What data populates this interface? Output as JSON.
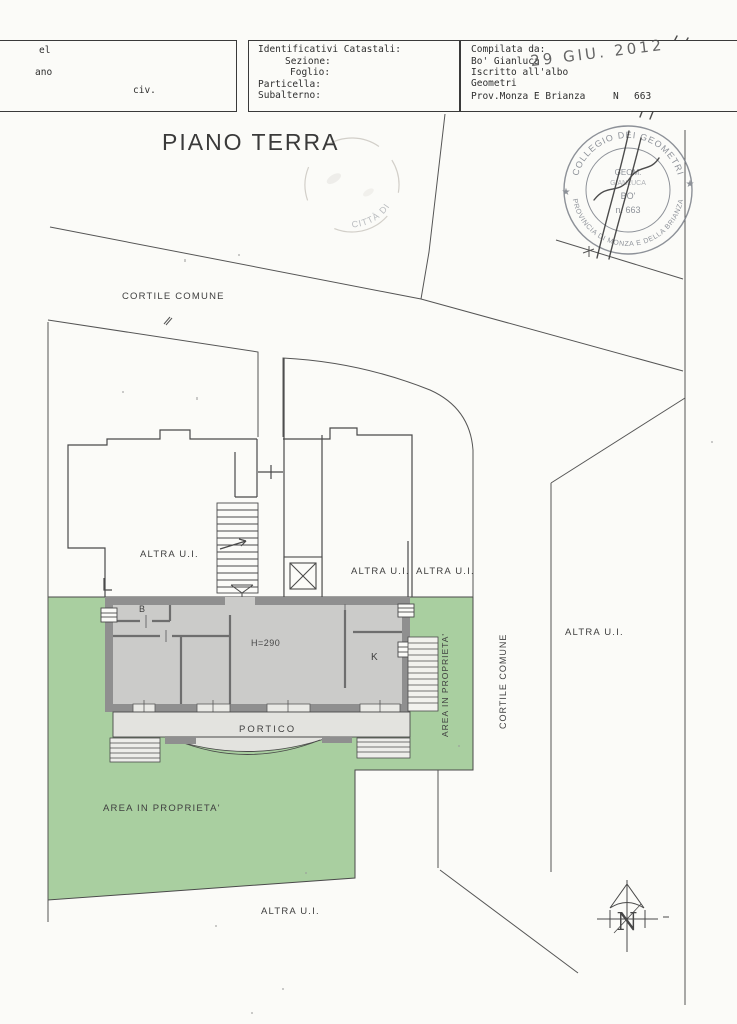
{
  "header": {
    "left_box": {
      "line1": "el",
      "line2": "ano",
      "line3": "civ."
    },
    "cadastral_box": {
      "title": "Identificativi Catastali:",
      "sezione": "Sezione:",
      "foglio": "Foglio:",
      "particella": "Particella:",
      "subalterno": "Subalterno:"
    },
    "compiler_box": {
      "compilata_da": "Compilata da:",
      "name": "Bo' Gianluca",
      "iscritto": "Iscritto all'albo",
      "geometri": "Geometri",
      "prov": "Prov.Monza E Brianza",
      "n_label": "N",
      "number": "663"
    },
    "date_stamp": "29 GIU. 2012"
  },
  "plan": {
    "title": "PIANO TERRA",
    "labels": {
      "cortile_comune": "CORTILE COMUNE",
      "altra_ui": "ALTRA U.I.",
      "area_in_proprieta": "AREA IN PROPRIETA'",
      "portico": "PORTICO",
      "room_b": "B",
      "room_k": "K",
      "height": "H=290",
      "north": "N"
    }
  },
  "stamps": {
    "collegio": {
      "arc_top": "COLLEGIO DEI GEOMETRI",
      "arc_bottom": "PROVINCIA DI MONZA E DELLA BRIANZA",
      "center_line1": "GEOM.",
      "center_line2": "GIANLUCA",
      "center_line3": "BO'",
      "center_line4": "n. 663",
      "star_left": "★",
      "star_right": "★"
    },
    "citta": {
      "text": "CITTÀ DI"
    }
  },
  "colors": {
    "green_area": "#a9cfa0",
    "wall_gray": "#8f8f8f",
    "room_gray": "#cbcbc9",
    "portico_gray": "#e3e3df",
    "steps_gray": "#ededea",
    "line": "#4a4a4a",
    "stamp_ink": "#7a7f88"
  }
}
